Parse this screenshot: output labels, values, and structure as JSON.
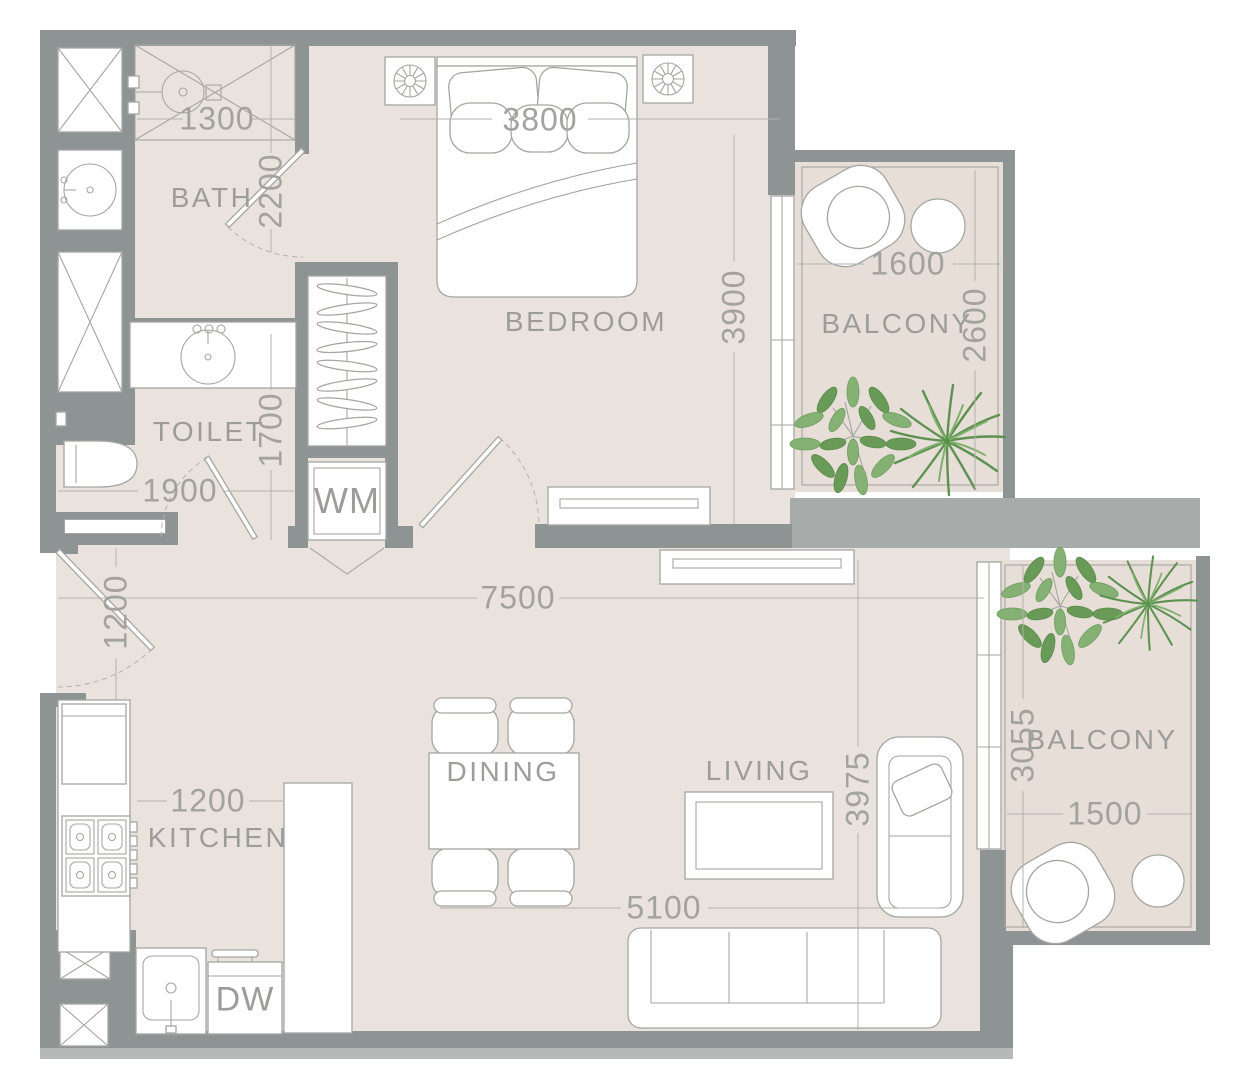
{
  "title": "One-bedroom apartment floor plan",
  "rooms": {
    "bath": "BATH",
    "toilet": "TOILET",
    "bedroom": "BEDROOM",
    "balcony_top": "BALCONY",
    "balcony_bottom": "BALCONY",
    "kitchen": "KITCHEN",
    "dining": "DINING",
    "living": "LIVING"
  },
  "appliances": {
    "washing_machine": "WM",
    "dishwasher": "DW"
  },
  "dimensions_mm": {
    "bath_width": "1300",
    "bath_depth": "2200",
    "bed_width": "3800",
    "bedroom_depth": "3900",
    "balcony_top_width": "1600",
    "balcony_top_depth": "2600",
    "toilet_depth": "1700",
    "toilet_width": "1900",
    "entry_width": "1200",
    "apartment_width": "7500",
    "kitchen_width": "1200",
    "living_depth": "3975",
    "living_width": "5100",
    "balcony_bottom_depth": "3055",
    "balcony_bottom_width": "1500"
  },
  "colors": {
    "wall": "#8e9494",
    "slab": "#a7abaa",
    "floor": "#eae3dd",
    "balcony_floor": "#e6ded7",
    "line": "#a5a6a1",
    "text": "#9c9c9a",
    "leaf_green": "#85b274",
    "palm_green": "#5d9150"
  }
}
